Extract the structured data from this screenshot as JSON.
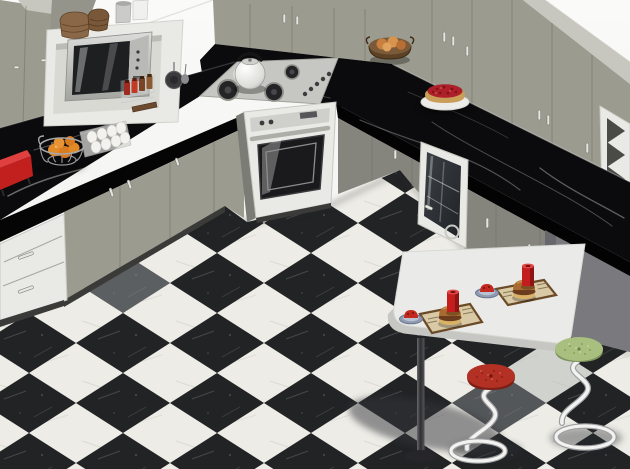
{
  "palette": {
    "bg_top": "#fafaf8",
    "bg_bottom": "#ededeb",
    "cabinet_gray": "#9b9b8f",
    "cabinet_gray_light": "#c7c7bf",
    "cabinet_gray_dark": "#85857d",
    "counter_black": "#0b0b0d",
    "floor_white": "#edece6",
    "floor_black": "#212325",
    "unit_white": "#e9e9e6",
    "steel": "#c6c6c2",
    "table_white": "#eaeae8",
    "panel_gray": "#7a7a7e",
    "stool_red": "#b23124",
    "stool_green": "#a9bf80",
    "candle_red": "#c41d1d",
    "tart_red": "#ad2029",
    "tart_crust": "#c99e58",
    "orange": "#e08a28",
    "wicker_brown": "#8a6847",
    "burger_bun": "#a86a2e",
    "placemat": "#d9c9a4",
    "oven_glass": "#1a1a1c"
  },
  "scene": {
    "objects": [
      "wall-cabinets",
      "microwave-shelf-unit",
      "microwave",
      "wicker-baskets",
      "storage-jars",
      "spice-rack",
      "hanging-pan",
      "pepper-mill",
      "egg-tray",
      "orange-wire-basket",
      "red-box",
      "black-marble-countertop",
      "gas-cooktop",
      "kettle",
      "wall-oven",
      "bread-bowl",
      "berry-tart",
      "glass-door-cabinet",
      "wine-rack-end-unit",
      "base-cabinets",
      "drawer-unit",
      "breakfast-table",
      "table-leg",
      "placemats",
      "burgers",
      "red-candles",
      "fruit-plates",
      "red-stool",
      "green-stool",
      "checkerboard-marble-floor"
    ]
  }
}
